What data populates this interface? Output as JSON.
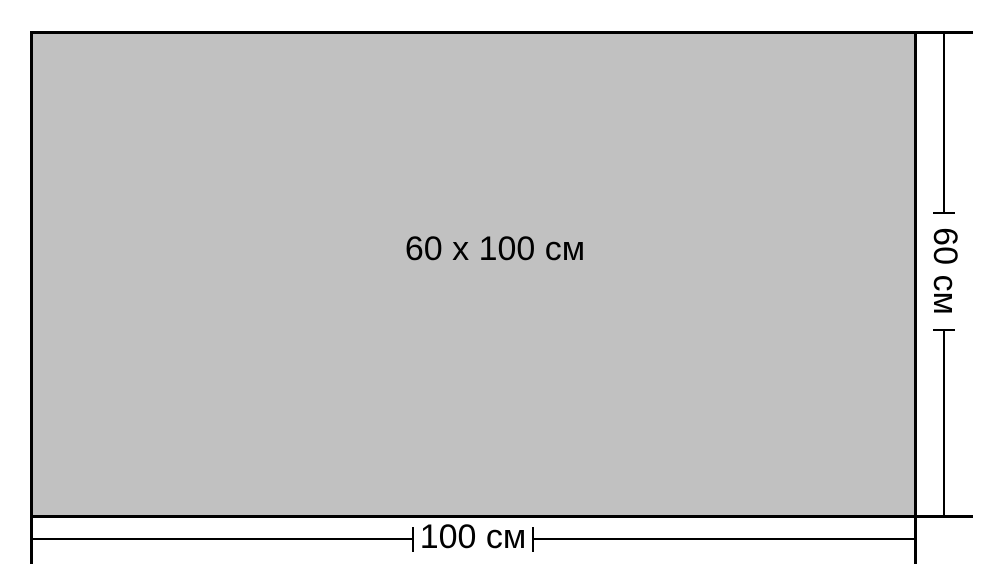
{
  "diagram": {
    "center_label": "60 x 100 см",
    "width_dimension": {
      "label": "100 см"
    },
    "height_dimension": {
      "label": "60 см"
    },
    "colors": {
      "rectangle_fill": "#c1c1c1",
      "line": "#000000",
      "background": "#ffffff"
    }
  }
}
